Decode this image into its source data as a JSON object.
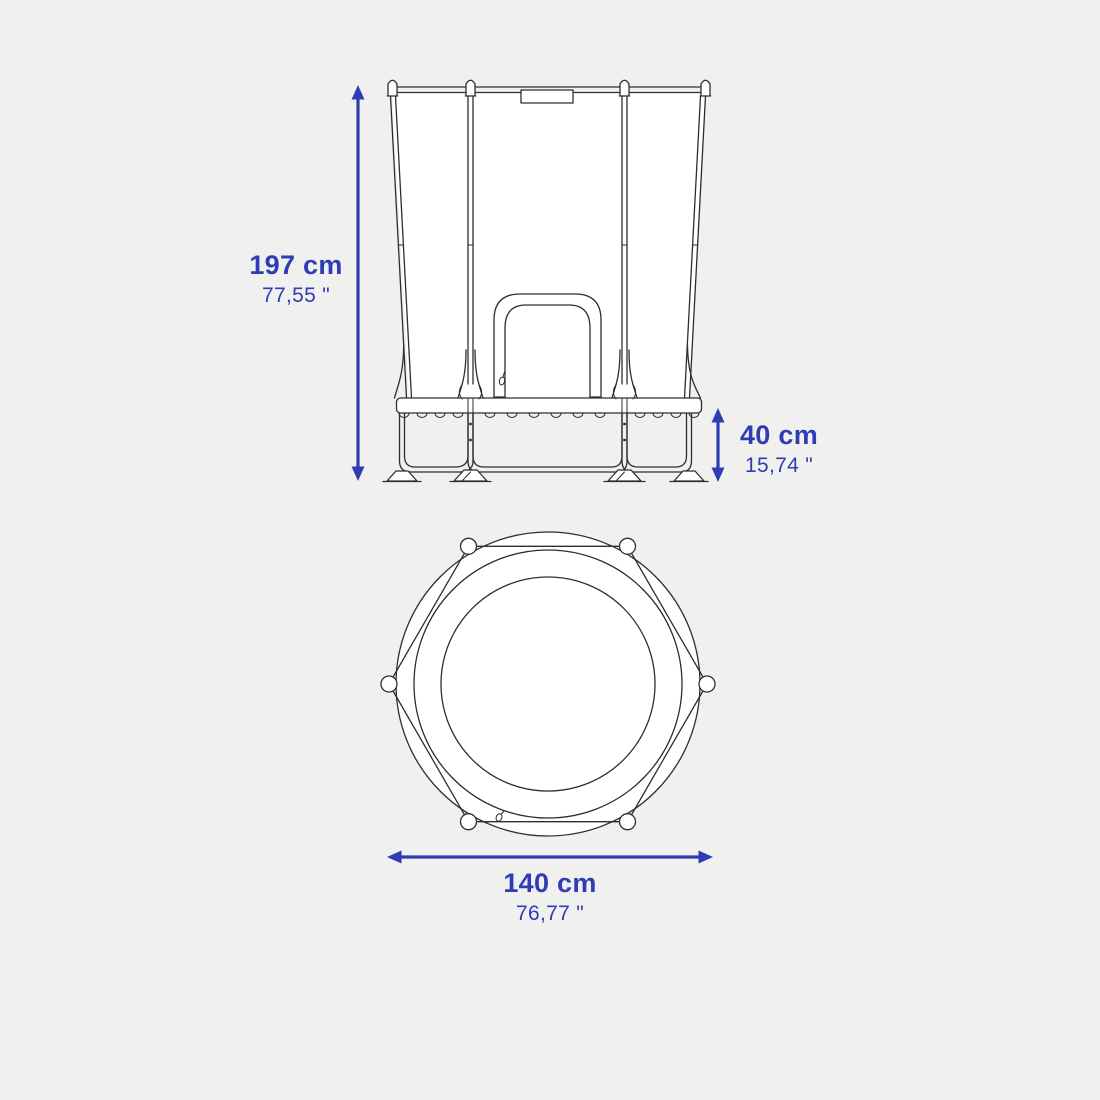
{
  "colors": {
    "bg": "#f0f0ef",
    "line": "#2e2e2e",
    "fill": "#ffffff",
    "accent": "#2f3cb4"
  },
  "dimensions": {
    "total_height": {
      "cm": "197 cm",
      "inch": "77,55 \""
    },
    "frame_height": {
      "cm": "40 cm",
      "inch": "15,74 \""
    },
    "diameter": {
      "cm": "140 cm",
      "inch": "76,77 \""
    }
  }
}
